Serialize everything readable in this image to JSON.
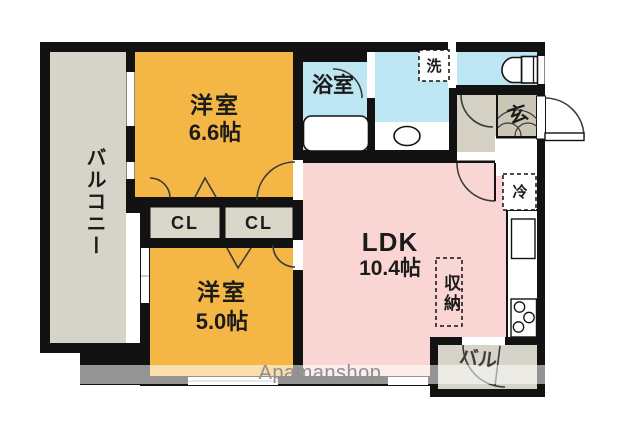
{
  "floorplan": {
    "balcony_label": "バルコニー",
    "room1_name": "洋室",
    "room1_size": "6.6帖",
    "room2_name": "洋室",
    "room2_size": "5.0帖",
    "ldk_name": "LDK",
    "ldk_size": "10.4帖",
    "bath_label": "浴室",
    "washer_label": "洗",
    "entrance_label": "玄",
    "fridge_label": "冷",
    "storage_label": "収納",
    "closet1_label": "CL",
    "closet2_label": "CL",
    "small_balcony_label": "バル"
  },
  "watermark": "Apamanshop",
  "colors": {
    "walls": "#121212",
    "western_room": "#f4b645",
    "ldk": "#f9d5d4",
    "wet_area": "#bde6f3",
    "balcony": "#d6d3c8",
    "closet": "#d9d6ca",
    "hallway_tile": "#d4d1c4",
    "entrance_tile": "#cbc7b6",
    "arc": "#3a3a3a",
    "watermark_text": "#8e8e8e"
  }
}
